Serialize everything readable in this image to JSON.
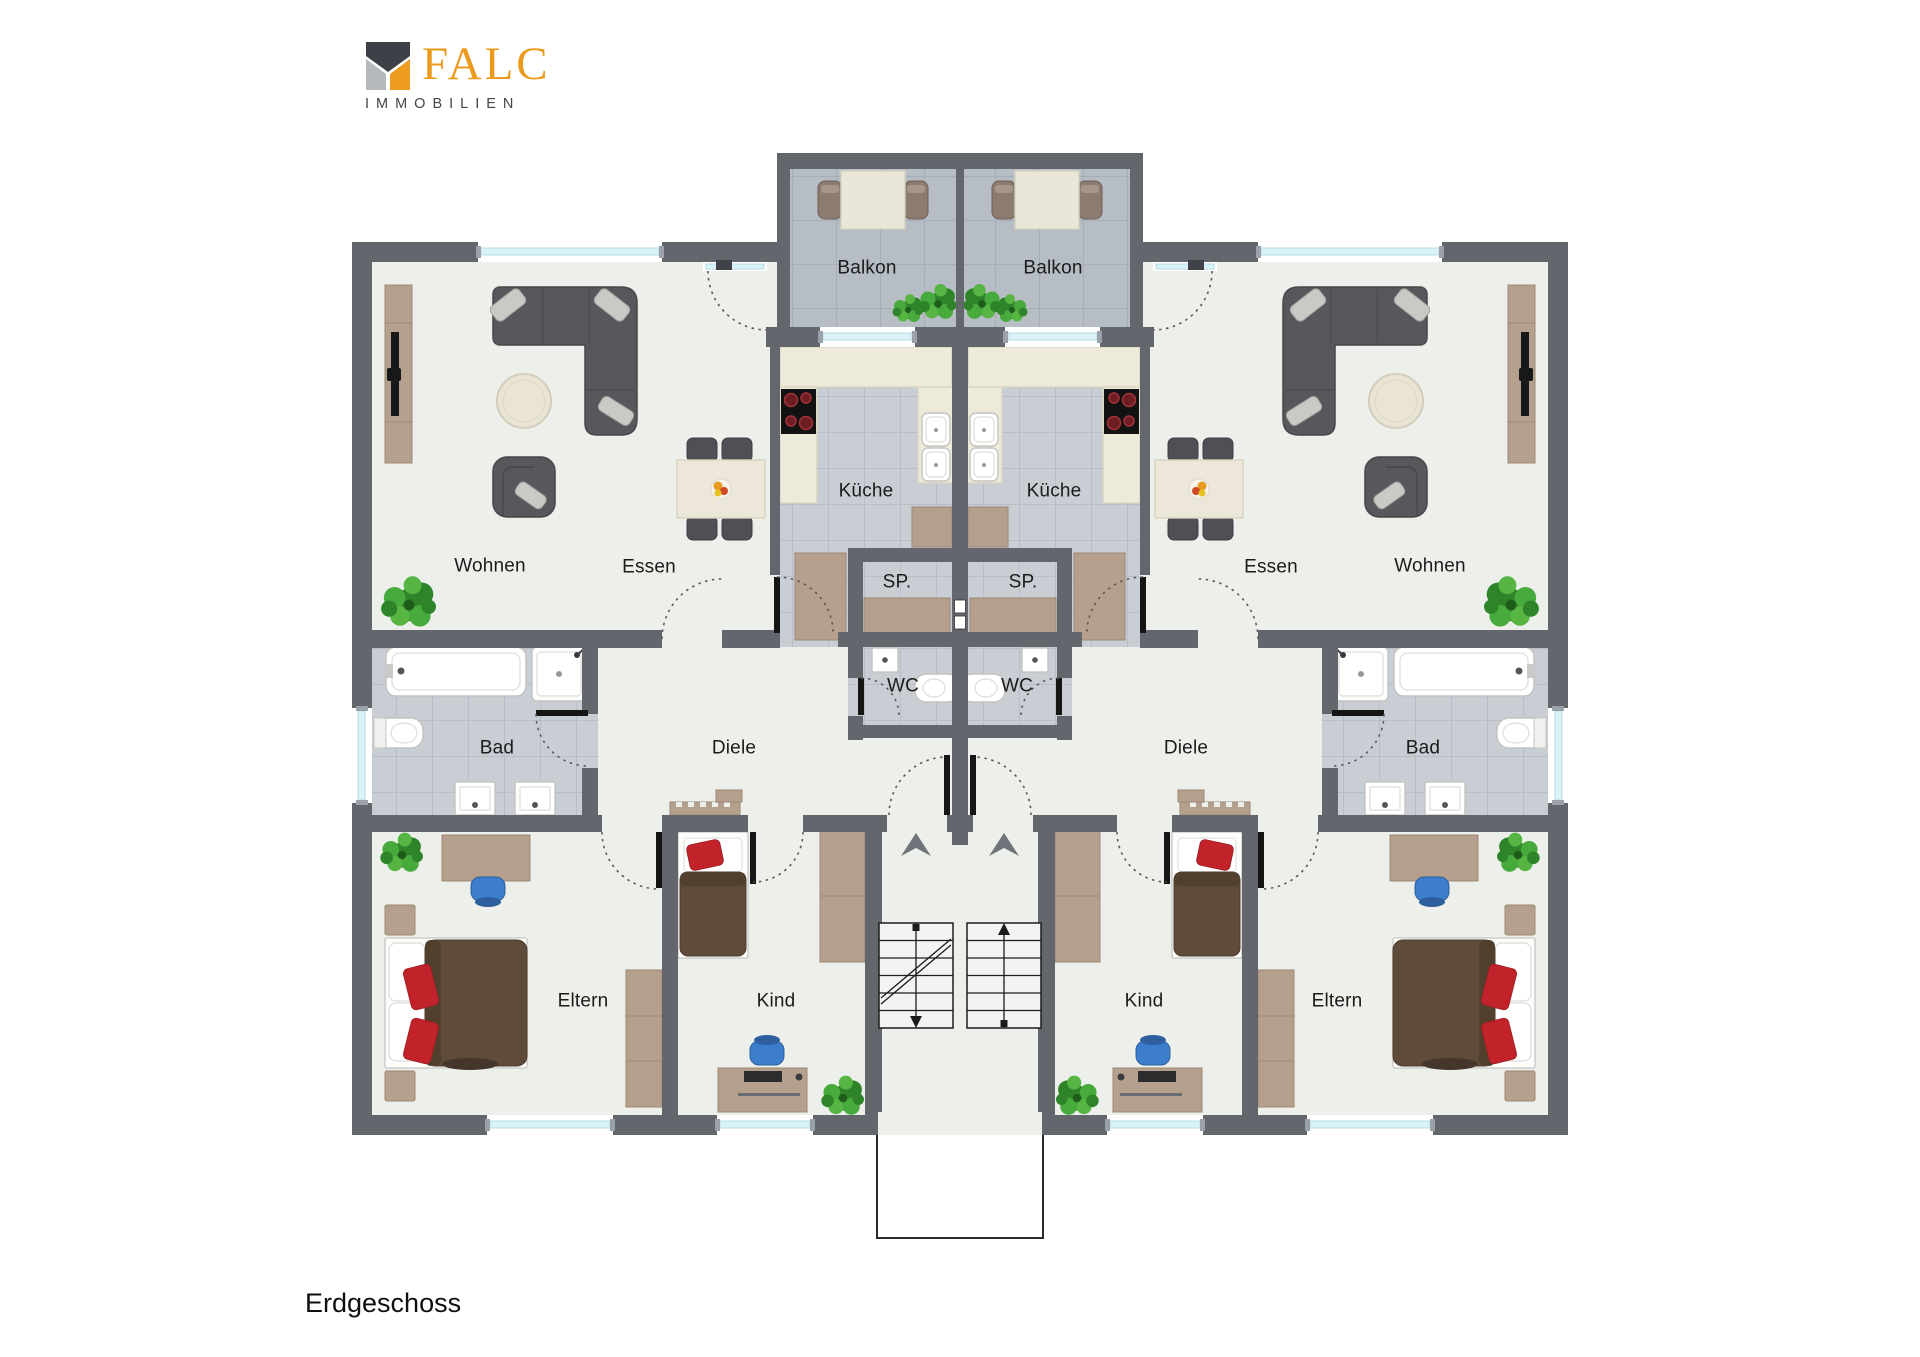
{
  "logo": {
    "brand": "FALC",
    "subtitle": "IMMOBILIEN",
    "mark_colors": {
      "dark": "#3d4147",
      "gray": "#b6b9bd",
      "orange": "#ee9c21"
    },
    "brand_color": "#ec9a1e"
  },
  "floor_label": "Erdgeschoss",
  "rooms": {
    "balkon": "Balkon",
    "kueche": "Küche",
    "sp": "SP.",
    "wc": "WC",
    "essen": "Essen",
    "wohnen": "Wohnen",
    "bad": "Bad",
    "diele": "Diele",
    "eltern": "Eltern",
    "kind": "Kind"
  },
  "colors": {
    "wall": "#63666c",
    "floor": "#edefeb",
    "tileK": "#c9ced4",
    "tileKline": "#b8bec6",
    "tileB": "#b7bdc5",
    "tileBline": "#a7aeb7",
    "wood": "#b4a08c",
    "woodB": "#9c8773",
    "cream": "#edead9",
    "creamB": "#d6d2bf",
    "sofa": "#56585c",
    "cushion": "#cac9c5",
    "glass": "#d9f2f8",
    "accentRed": "#c2232b",
    "bedBrown": "#5f4b39",
    "chairBlue": "#3c7ecb",
    "plantGreen": "#2f8429",
    "brand": "#ec9a1e",
    "label": "#1b1b1b"
  }
}
